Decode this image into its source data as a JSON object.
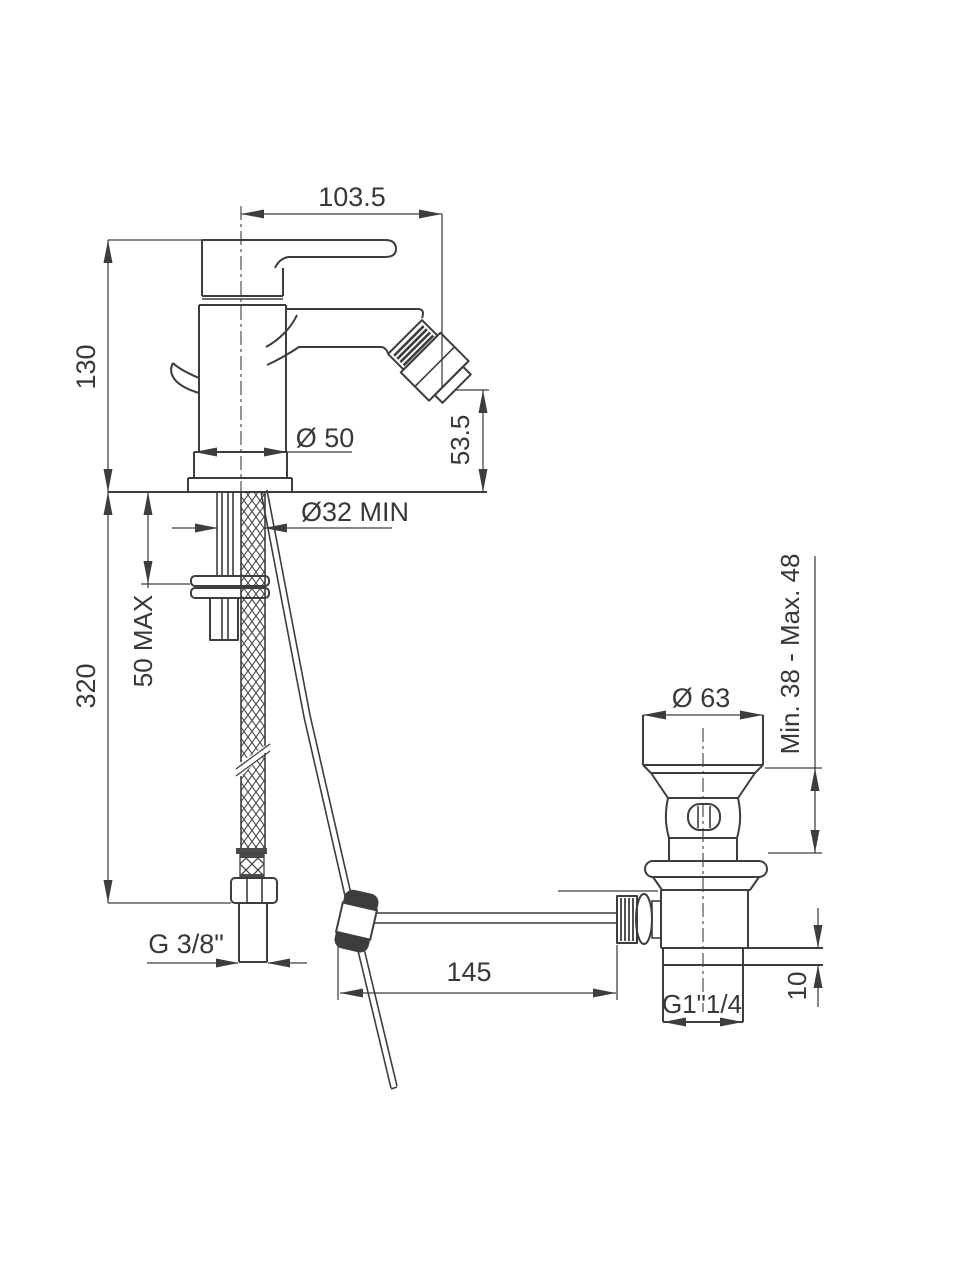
{
  "page": {
    "background": "#ffffff"
  },
  "drawing": {
    "line_color": "#3d3d3d",
    "text_color": "#383838",
    "labels": {
      "spout_reach": "103.5",
      "total_height": "130",
      "base_diameter": "Ø 50",
      "outlet_height": "53.5",
      "mounting_hole": "Ø32 MIN",
      "max_deck_thickness": "50 MAX",
      "supply_length": "320",
      "waste_flange_diameter": "Ø 63",
      "waste_height_range": "Min. 38 - Max. 48",
      "supply_thread": "G 3/8\"",
      "rod_reach": "145",
      "waste_thread": "G1\"1/4",
      "flange_thickness": "10"
    }
  }
}
